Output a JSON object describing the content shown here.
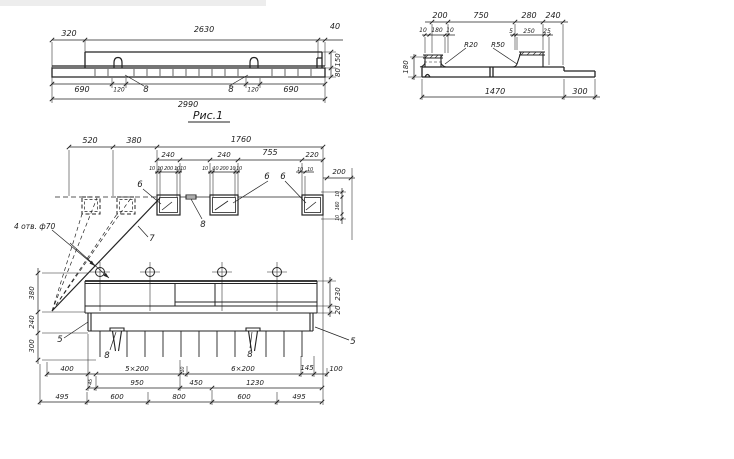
{
  "page": {
    "background": "#ffffff",
    "ink": "#232323"
  },
  "figure_caption": "Рис.1",
  "elevation": {
    "dims_top": [
      "320",
      "2630",
      "40"
    ],
    "dims_right": [
      "150",
      "80"
    ],
    "dims_bottom": [
      "690",
      "120",
      "8",
      "8",
      "120",
      "690"
    ],
    "dim_total": "2990"
  },
  "section": {
    "dims_top": [
      "200",
      "750",
      "280",
      "240"
    ],
    "dims_sub": [
      "10",
      "180",
      "10",
      "5",
      "250",
      "25"
    ],
    "radius_labels": [
      "R20",
      "R50"
    ],
    "dim_left": "180",
    "dims_bottom": [
      "1470",
      "300"
    ]
  },
  "plan": {
    "dims_top": [
      "520",
      "380",
      "1760"
    ],
    "dims_row2": [
      "240",
      "240",
      "755",
      "220"
    ],
    "dims_openings": [
      "10",
      "10 200 10",
      "10",
      "10",
      "10 200 10",
      "10",
      "10",
      "10"
    ],
    "dim_right_200": "200",
    "dims_right_small": [
      "10",
      "160",
      "10"
    ],
    "dims_right_side": [
      "230",
      "20"
    ],
    "dims_left_side": [
      "380",
      "240",
      "300"
    ],
    "note_holes": "4 отв. ф70",
    "labels": {
      "five_left": "5",
      "five_right": "5",
      "six_1": "6",
      "six_2": "6",
      "six_3": "6",
      "seven": "7",
      "eight_top": "8",
      "eight_loop1": "8",
      "eight_loop2": "8"
    },
    "dims_bottom1": [
      "400",
      "45",
      "5×200",
      "110",
      "6×200",
      "145",
      "100"
    ],
    "dims_bottom2": [
      "950",
      "450",
      "1230"
    ],
    "dims_bottom3": [
      "495",
      "600",
      "800",
      "600",
      "495"
    ]
  }
}
